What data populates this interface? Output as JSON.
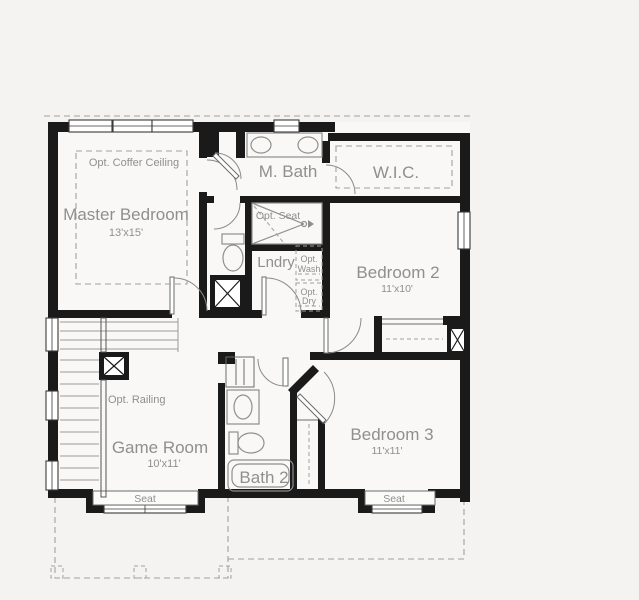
{
  "rooms": {
    "master": {
      "label": "Master Bedroom",
      "dims": "13'x15'"
    },
    "mbath": {
      "label": "M. Bath"
    },
    "wic": {
      "label": "W.I.C."
    },
    "bedroom2": {
      "label": "Bedroom 2",
      "dims": "11'x10'"
    },
    "bedroom3": {
      "label": "Bedroom 3",
      "dims": "11'x11'"
    },
    "gameroom": {
      "label": "Game Room",
      "dims": "10'x11'"
    },
    "bath2": {
      "label": "Bath 2"
    },
    "laundry": {
      "label": "Lndry"
    }
  },
  "options": {
    "coffer_ceiling": "Opt. Coffer Ceiling",
    "shower_seat": "Opt. Seat",
    "railing": "Opt. Railing",
    "washer": {
      "line1": "Opt.",
      "line2": "Wash"
    },
    "dryer": {
      "line1": "Opt.",
      "line2": "Dry"
    }
  },
  "features": {
    "window_seat_left": "Seat",
    "window_seat_right": "Seat"
  },
  "colors": {
    "wall": "#1a1a1a",
    "label": "#8f8f8f",
    "dash": "#a0a0a0",
    "background": "#f4f3f1",
    "interior": "#f9f8f6"
  }
}
